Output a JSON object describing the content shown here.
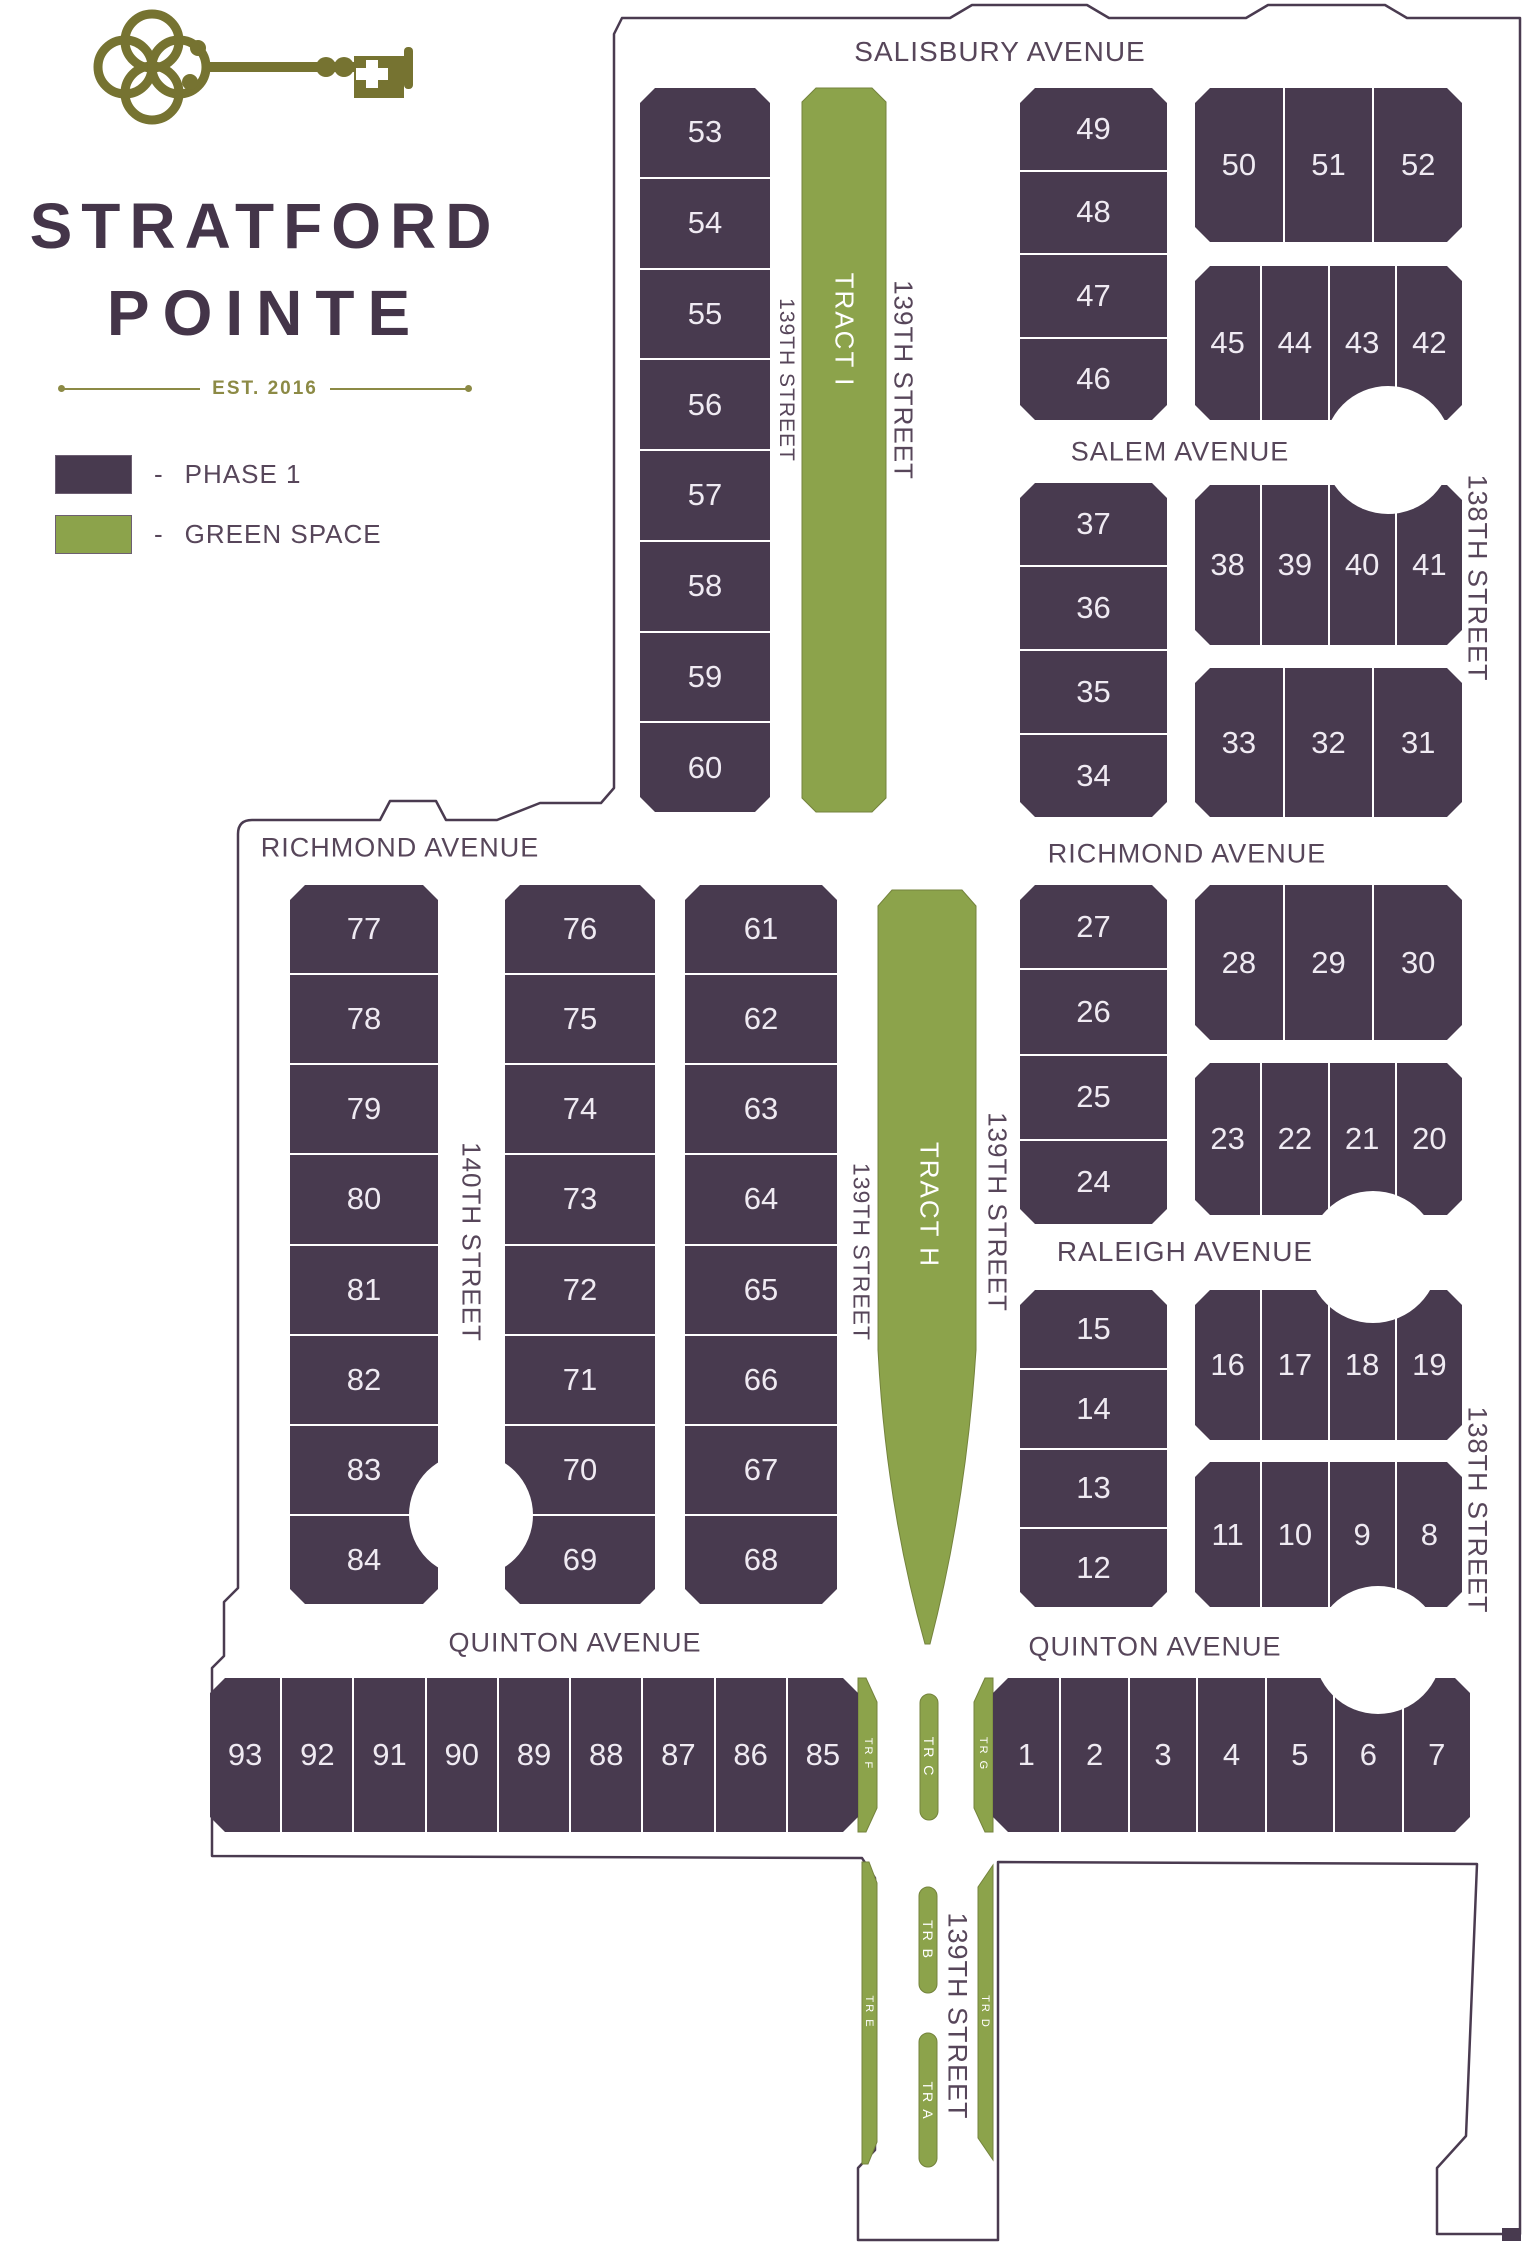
{
  "logo": {
    "title_line1": "STRATFORD",
    "title_line2": "POINTE",
    "established": "EST. 2016",
    "key_icon": "antique-key-icon"
  },
  "legend": {
    "items": [
      {
        "dash": "-",
        "label": "PHASE 1",
        "color": "#483A4F"
      },
      {
        "dash": "-",
        "label": "GREEN SPACE",
        "color": "#8CA34B"
      }
    ]
  },
  "colors": {
    "phase1": "#483A4F",
    "green_space": "#8CA34B",
    "logo_olive": "#767331",
    "title_purple": "#443549",
    "street_text": "#57465A",
    "boundary": "#4A3B50"
  },
  "map": {
    "street_labels": [
      {
        "id": "salisbury-avenue",
        "label": "SALISBURY AVENUE",
        "x": 1000,
        "y": 52,
        "rot": 0,
        "size": 28
      },
      {
        "id": "salem-avenue",
        "label": "SALEM AVENUE",
        "x": 1180,
        "y": 452,
        "rot": 0,
        "size": 27
      },
      {
        "id": "richmond-avenue-west",
        "label": "RICHMOND AVENUE",
        "x": 400,
        "y": 848,
        "rot": 0,
        "size": 27
      },
      {
        "id": "richmond-avenue-east",
        "label": "RICHMOND AVENUE",
        "x": 1187,
        "y": 854,
        "rot": 0,
        "size": 27
      },
      {
        "id": "raleigh-avenue",
        "label": "RALEIGH AVENUE",
        "x": 1185,
        "y": 1252,
        "rot": 0,
        "size": 28
      },
      {
        "id": "quinton-avenue-west",
        "label": "QUINTON AVENUE",
        "x": 575,
        "y": 1643,
        "rot": 0,
        "size": 27
      },
      {
        "id": "quinton-avenue-east",
        "label": "QUINTON AVENUE",
        "x": 1155,
        "y": 1647,
        "rot": 0,
        "size": 27
      },
      {
        "id": "139th-street-upper-left",
        "label": "139TH STREET",
        "x": 786,
        "y": 380,
        "rot": 90,
        "size": 21
      },
      {
        "id": "139th-street-upper-right",
        "label": "139TH STREET",
        "x": 903,
        "y": 380,
        "rot": 90,
        "size": 26
      },
      {
        "id": "138th-street-upper",
        "label": "138TH STREET",
        "x": 1477,
        "y": 578,
        "rot": 90,
        "size": 27
      },
      {
        "id": "138th-street-lower",
        "label": "138TH STREET",
        "x": 1477,
        "y": 1510,
        "rot": 90,
        "size": 27
      },
      {
        "id": "140th-street",
        "label": "140TH STREET",
        "x": 471,
        "y": 1242,
        "rot": 90,
        "size": 26
      },
      {
        "id": "139th-street-mid-left",
        "label": "139TH STREET",
        "x": 861,
        "y": 1252,
        "rot": 90,
        "size": 23
      },
      {
        "id": "139th-street-mid-right",
        "label": "139TH STREET",
        "x": 997,
        "y": 1212,
        "rot": 90,
        "size": 26
      },
      {
        "id": "139th-street-south",
        "label": "139TH STREET",
        "x": 957,
        "y": 2016,
        "rot": 90,
        "size": 27
      }
    ],
    "tract_labels": [
      {
        "id": "tract-i",
        "label": "TRACT I",
        "x": 844,
        "y": 330,
        "size": 26
      },
      {
        "id": "tract-h",
        "label": "TRACT H",
        "x": 929,
        "y": 1205,
        "size": 26
      },
      {
        "id": "tr-f",
        "label": "TR F",
        "x": 868,
        "y": 1754,
        "size": 11
      },
      {
        "id": "tr-c",
        "label": "TR C",
        "x": 929,
        "y": 1757,
        "size": 14
      },
      {
        "id": "tr-g",
        "label": "TR G",
        "x": 983,
        "y": 1754,
        "size": 11
      },
      {
        "id": "tr-e",
        "label": "TR E",
        "x": 869,
        "y": 2012,
        "size": 11
      },
      {
        "id": "tr-b",
        "label": "TR B",
        "x": 928,
        "y": 1940,
        "size": 14
      },
      {
        "id": "tr-a",
        "label": "TR A",
        "x": 928,
        "y": 2101,
        "size": 14
      },
      {
        "id": "tr-d",
        "label": "TR D",
        "x": 985,
        "y": 2012,
        "size": 11
      }
    ],
    "blocks": [
      {
        "id": "53-60",
        "x": 640,
        "y": 88,
        "w": 130,
        "h": 724,
        "dir": "column",
        "lots": [
          "53",
          "54",
          "55",
          "56",
          "57",
          "58",
          "59",
          "60"
        ]
      },
      {
        "id": "49-46",
        "x": 1020,
        "y": 88,
        "w": 147,
        "h": 332,
        "dir": "column",
        "lots": [
          "49",
          "48",
          "47",
          "46"
        ]
      },
      {
        "id": "50-52",
        "x": 1195,
        "y": 88,
        "w": 267,
        "h": 154,
        "dir": "row",
        "lots": [
          "50",
          "51",
          "52"
        ]
      },
      {
        "id": "45-42",
        "x": 1195,
        "y": 266,
        "w": 267,
        "h": 154,
        "dir": "row",
        "lots": [
          "45",
          "44",
          "43",
          "42"
        ]
      },
      {
        "id": "37-34",
        "x": 1020,
        "y": 483,
        "w": 147,
        "h": 334,
        "dir": "column",
        "lots": [
          "37",
          "36",
          "35",
          "34"
        ]
      },
      {
        "id": "38-41",
        "x": 1195,
        "y": 485,
        "w": 267,
        "h": 160,
        "dir": "row",
        "lots": [
          "38",
          "39",
          "40",
          "41"
        ]
      },
      {
        "id": "33-31",
        "x": 1195,
        "y": 668,
        "w": 267,
        "h": 149,
        "dir": "row",
        "lots": [
          "33",
          "32",
          "31"
        ]
      },
      {
        "id": "77-84",
        "x": 290,
        "y": 885,
        "w": 148,
        "h": 719,
        "dir": "column",
        "lots": [
          "77",
          "78",
          "79",
          "80",
          "81",
          "82",
          "83",
          "84"
        ]
      },
      {
        "id": "76-69",
        "x": 505,
        "y": 885,
        "w": 150,
        "h": 719,
        "dir": "column",
        "lots": [
          "76",
          "75",
          "74",
          "73",
          "72",
          "71",
          "70",
          "69"
        ]
      },
      {
        "id": "61-68",
        "x": 685,
        "y": 885,
        "w": 152,
        "h": 719,
        "dir": "column",
        "lots": [
          "61",
          "62",
          "63",
          "64",
          "65",
          "66",
          "67",
          "68"
        ]
      },
      {
        "id": "27-24",
        "x": 1020,
        "y": 885,
        "w": 147,
        "h": 339,
        "dir": "column",
        "lots": [
          "27",
          "26",
          "25",
          "24"
        ]
      },
      {
        "id": "28-30",
        "x": 1195,
        "y": 885,
        "w": 267,
        "h": 155,
        "dir": "row",
        "lots": [
          "28",
          "29",
          "30"
        ]
      },
      {
        "id": "23-20",
        "x": 1195,
        "y": 1063,
        "w": 267,
        "h": 152,
        "dir": "row",
        "lots": [
          "23",
          "22",
          "21",
          "20"
        ]
      },
      {
        "id": "15-12",
        "x": 1020,
        "y": 1290,
        "w": 147,
        "h": 317,
        "dir": "column",
        "lots": [
          "15",
          "14",
          "13",
          "12"
        ]
      },
      {
        "id": "16-19",
        "x": 1195,
        "y": 1290,
        "w": 267,
        "h": 150,
        "dir": "row",
        "lots": [
          "16",
          "17",
          "18",
          "19"
        ]
      },
      {
        "id": "11-8",
        "x": 1195,
        "y": 1462,
        "w": 267,
        "h": 145,
        "dir": "row",
        "lots": [
          "11",
          "10",
          "9",
          "8"
        ]
      },
      {
        "id": "93-85",
        "x": 210,
        "y": 1678,
        "w": 648,
        "h": 154,
        "dir": "row",
        "lots": [
          "93",
          "92",
          "91",
          "90",
          "89",
          "88",
          "87",
          "86",
          "85"
        ]
      },
      {
        "id": "1-7",
        "x": 993,
        "y": 1678,
        "w": 477,
        "h": 154,
        "dir": "row",
        "lots": [
          "1",
          "2",
          "3",
          "4",
          "5",
          "6",
          "7"
        ]
      }
    ]
  }
}
